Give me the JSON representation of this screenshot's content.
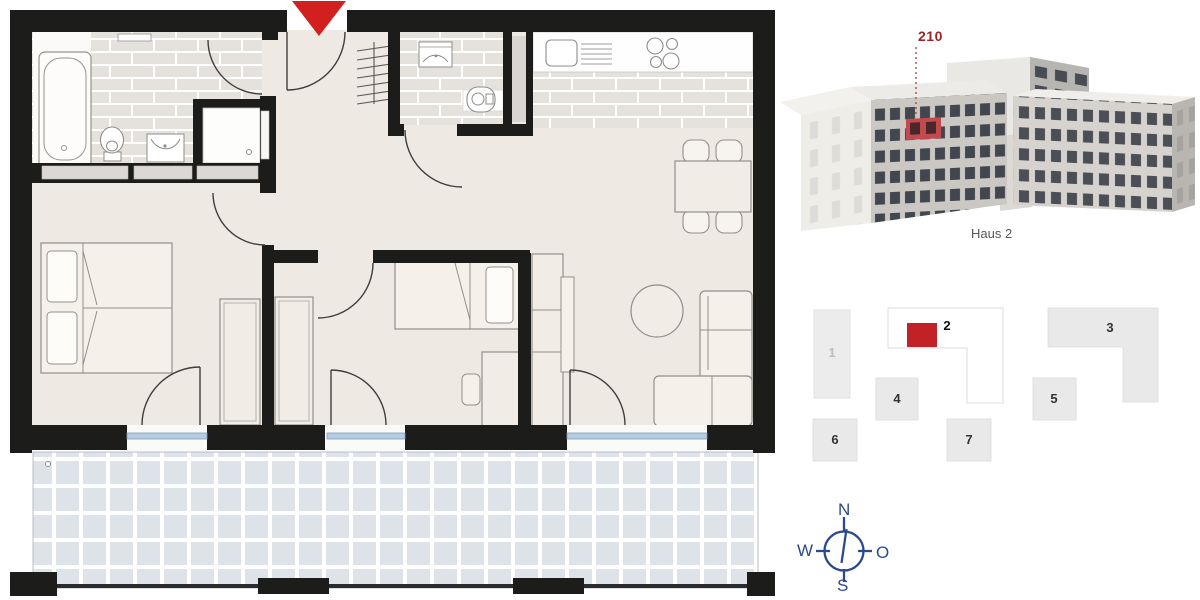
{
  "building_panel": {
    "unit_number": "210",
    "building_name": "Haus 2"
  },
  "site_plan": {
    "blocks": [
      {
        "label": "1"
      },
      {
        "label": "2"
      },
      {
        "label": "3"
      },
      {
        "label": "4"
      },
      {
        "label": "5"
      },
      {
        "label": "6"
      },
      {
        "label": "7"
      }
    ],
    "highlighted_block": "2"
  },
  "compass": {
    "north": "N",
    "east": "O",
    "south": "S",
    "west": "W"
  },
  "colors": {
    "wall": "#1c1c1a",
    "floor": "#efe9e3",
    "bathroom_tile": "#e5e2dd",
    "balcony_tile": "#dee3ea",
    "window_blue": "#b5cde1",
    "entrance_arrow_red": "#d2201f",
    "accent_red": "#c22127",
    "compass_blue": "#2b4a8b"
  },
  "icons": {
    "entrance_arrow": "▼",
    "compass_rose": "circle with N/W/O/S ticks"
  }
}
